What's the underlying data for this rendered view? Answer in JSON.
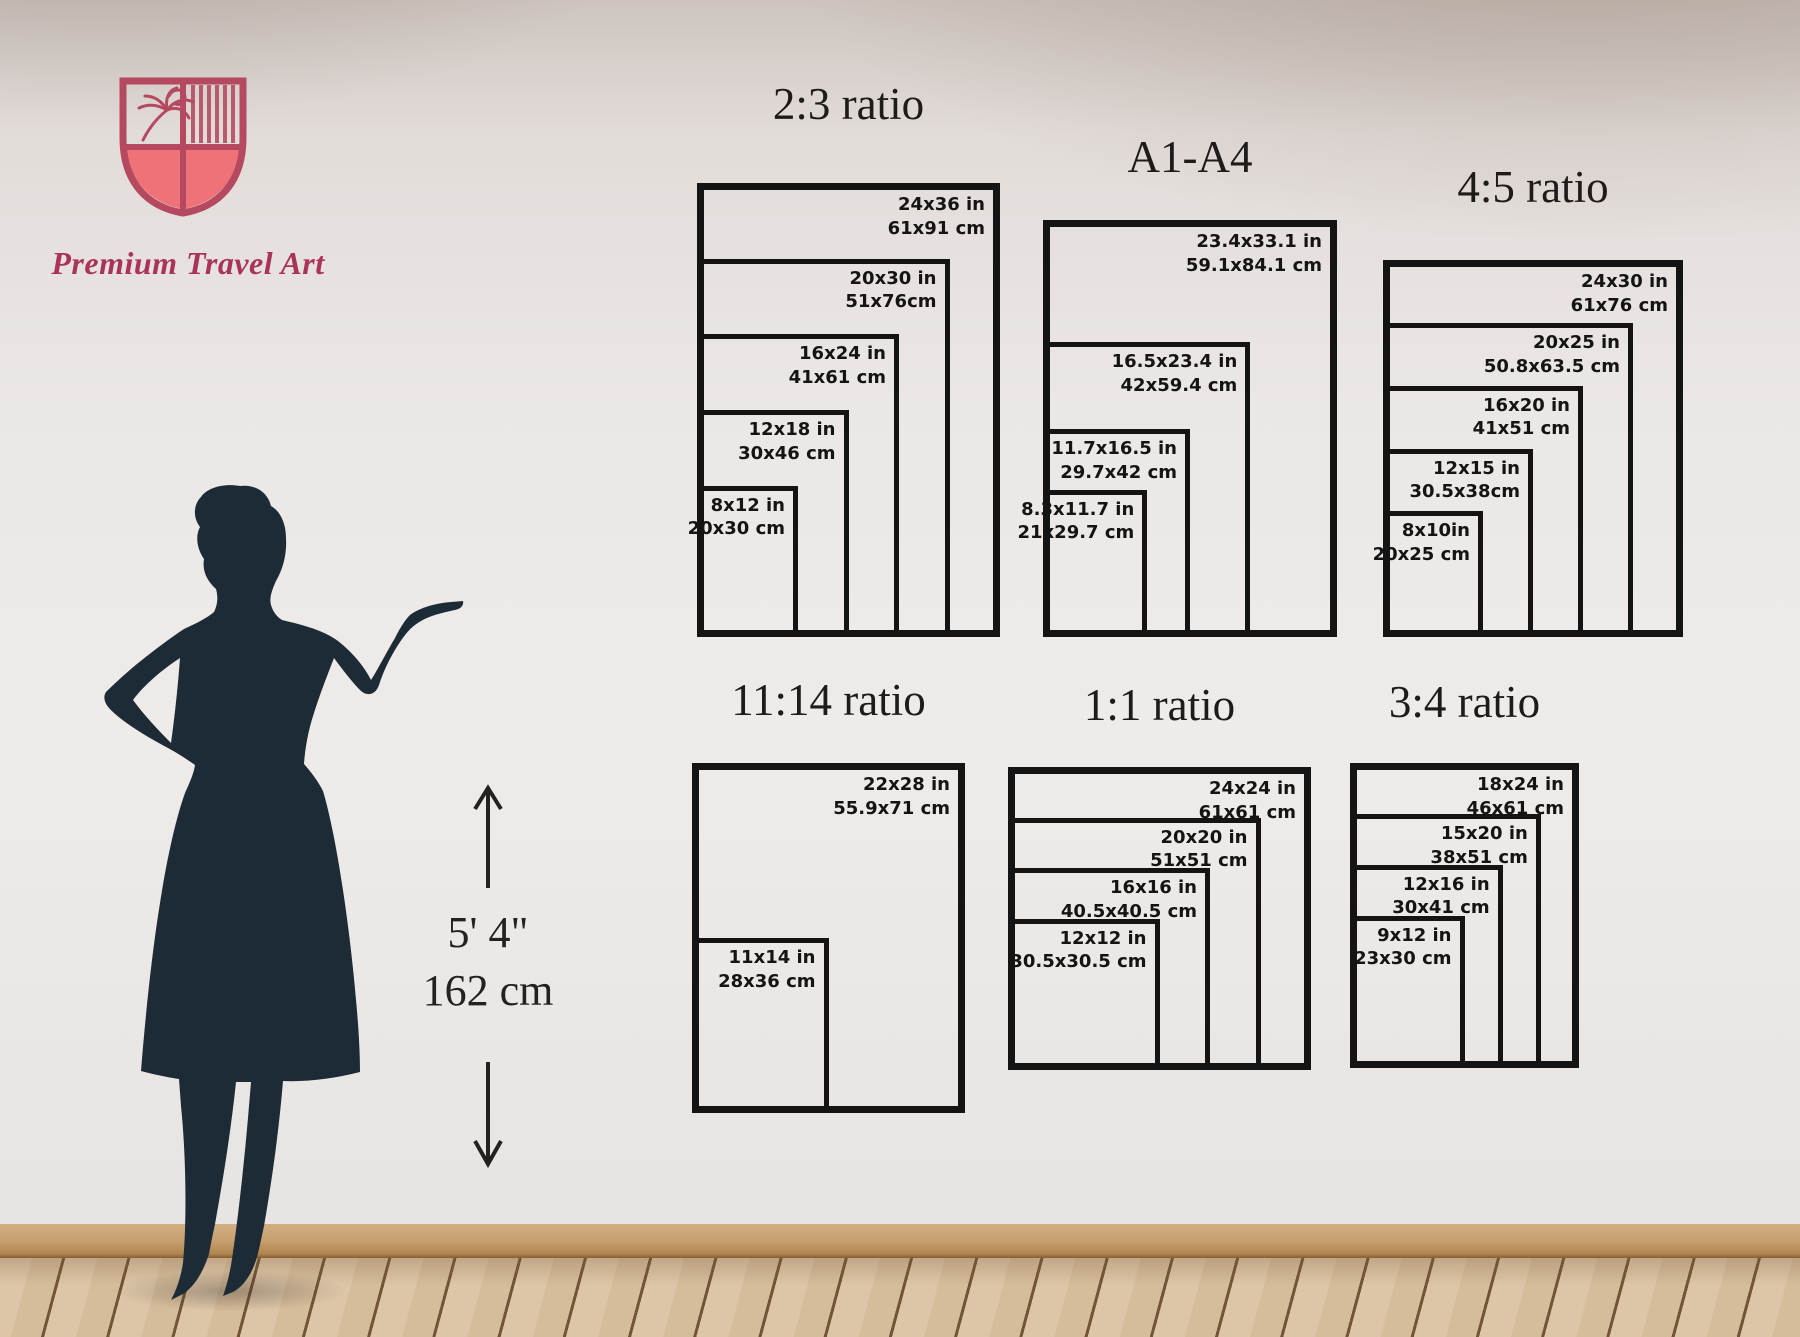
{
  "brand": {
    "name": "Premium Travel Art",
    "logo_colors": {
      "outline": "#b5495f",
      "fill": "#ee7277",
      "text": "#a93457"
    }
  },
  "scale_figure": {
    "label_imperial": "5' 4\"",
    "label_metric": "162 cm"
  },
  "charts": [
    {
      "id": "2-3",
      "title": "2:3 ratio",
      "unit_outer": {
        "w": 24,
        "h": 36
      },
      "layout": {
        "left": 697,
        "top": 183,
        "width": 303,
        "height": 454,
        "title_top": 80
      },
      "sizes": [
        {
          "w": 24,
          "h": 36,
          "inches": "24x36 in",
          "cm": "61x91 cm"
        },
        {
          "w": 20,
          "h": 30,
          "inches": "20x30 in",
          "cm": "51x76cm"
        },
        {
          "w": 16,
          "h": 24,
          "inches": "16x24 in",
          "cm": "41x61 cm"
        },
        {
          "w": 12,
          "h": 18,
          "inches": "12x18 in",
          "cm": "30x46 cm"
        },
        {
          "w": 8,
          "h": 12,
          "inches": "8x12 in",
          "cm": "20x30 cm"
        }
      ]
    },
    {
      "id": "a1-a4",
      "title": "A1-A4",
      "unit_outer": {
        "w": 23.4,
        "h": 33.1
      },
      "layout": {
        "left": 1043,
        "top": 220,
        "width": 294,
        "height": 417,
        "title_top": 133
      },
      "sizes": [
        {
          "w": 23.4,
          "h": 33.1,
          "inches": "23.4x33.1 in",
          "cm": "59.1x84.1 cm"
        },
        {
          "w": 16.5,
          "h": 23.4,
          "inches": "16.5x23.4 in",
          "cm": "42x59.4 cm"
        },
        {
          "w": 11.7,
          "h": 16.5,
          "inches": "11.7x16.5 in",
          "cm": "29.7x42 cm"
        },
        {
          "w": 8.3,
          "h": 11.7,
          "inches": "8.3x11.7 in",
          "cm": "21x29.7 cm"
        }
      ]
    },
    {
      "id": "4-5",
      "title": "4:5 ratio",
      "unit_outer": {
        "w": 24,
        "h": 30
      },
      "layout": {
        "left": 1383,
        "top": 260,
        "width": 300,
        "height": 377,
        "title_top": 163
      },
      "sizes": [
        {
          "w": 24,
          "h": 30,
          "inches": "24x30 in",
          "cm": "61x76 cm"
        },
        {
          "w": 20,
          "h": 25,
          "inches": "20x25 in",
          "cm": "50.8x63.5 cm"
        },
        {
          "w": 16,
          "h": 20,
          "inches": "16x20 in",
          "cm": "41x51 cm"
        },
        {
          "w": 12,
          "h": 15,
          "inches": "12x15 in",
          "cm": "30.5x38cm"
        },
        {
          "w": 8,
          "h": 10,
          "inches": "8x10in",
          "cm": "20x25 cm"
        }
      ]
    },
    {
      "id": "11-14",
      "title": "11:14 ratio",
      "unit_outer": {
        "w": 22,
        "h": 28
      },
      "layout": {
        "left": 692,
        "top": 763,
        "width": 273,
        "height": 350,
        "title_top": 676
      },
      "sizes": [
        {
          "w": 22,
          "h": 28,
          "inches": "22x28 in",
          "cm": "55.9x71 cm"
        },
        {
          "w": 11,
          "h": 14,
          "inches": "11x14 in",
          "cm": "28x36 cm"
        }
      ]
    },
    {
      "id": "1-1",
      "title": "1:1 ratio",
      "unit_outer": {
        "w": 24,
        "h": 24
      },
      "layout": {
        "left": 1008,
        "top": 767,
        "width": 303,
        "height": 303,
        "title_top": 681
      },
      "sizes": [
        {
          "w": 24,
          "h": 24,
          "inches": "24x24 in",
          "cm": "61x61 cm"
        },
        {
          "w": 20,
          "h": 20,
          "inches": "20x20 in",
          "cm": "51x51 cm"
        },
        {
          "w": 16,
          "h": 16,
          "inches": "16x16 in",
          "cm": "40.5x40.5 cm"
        },
        {
          "w": 12,
          "h": 12,
          "inches": "12x12 in",
          "cm": "30.5x30.5 cm"
        }
      ]
    },
    {
      "id": "3-4",
      "title": "3:4 ratio",
      "unit_outer": {
        "w": 18,
        "h": 24
      },
      "layout": {
        "left": 1350,
        "top": 763,
        "width": 229,
        "height": 305,
        "title_top": 678
      },
      "sizes": [
        {
          "w": 18,
          "h": 24,
          "inches": "18x24 in",
          "cm": "46x61 cm"
        },
        {
          "w": 15,
          "h": 20,
          "inches": "15x20 in",
          "cm": "38x51 cm"
        },
        {
          "w": 12,
          "h": 16,
          "inches": "12x16 in",
          "cm": "30x41 cm"
        },
        {
          "w": 9,
          "h": 12,
          "inches": "9x12 in",
          "cm": "23x30 cm"
        }
      ]
    }
  ]
}
